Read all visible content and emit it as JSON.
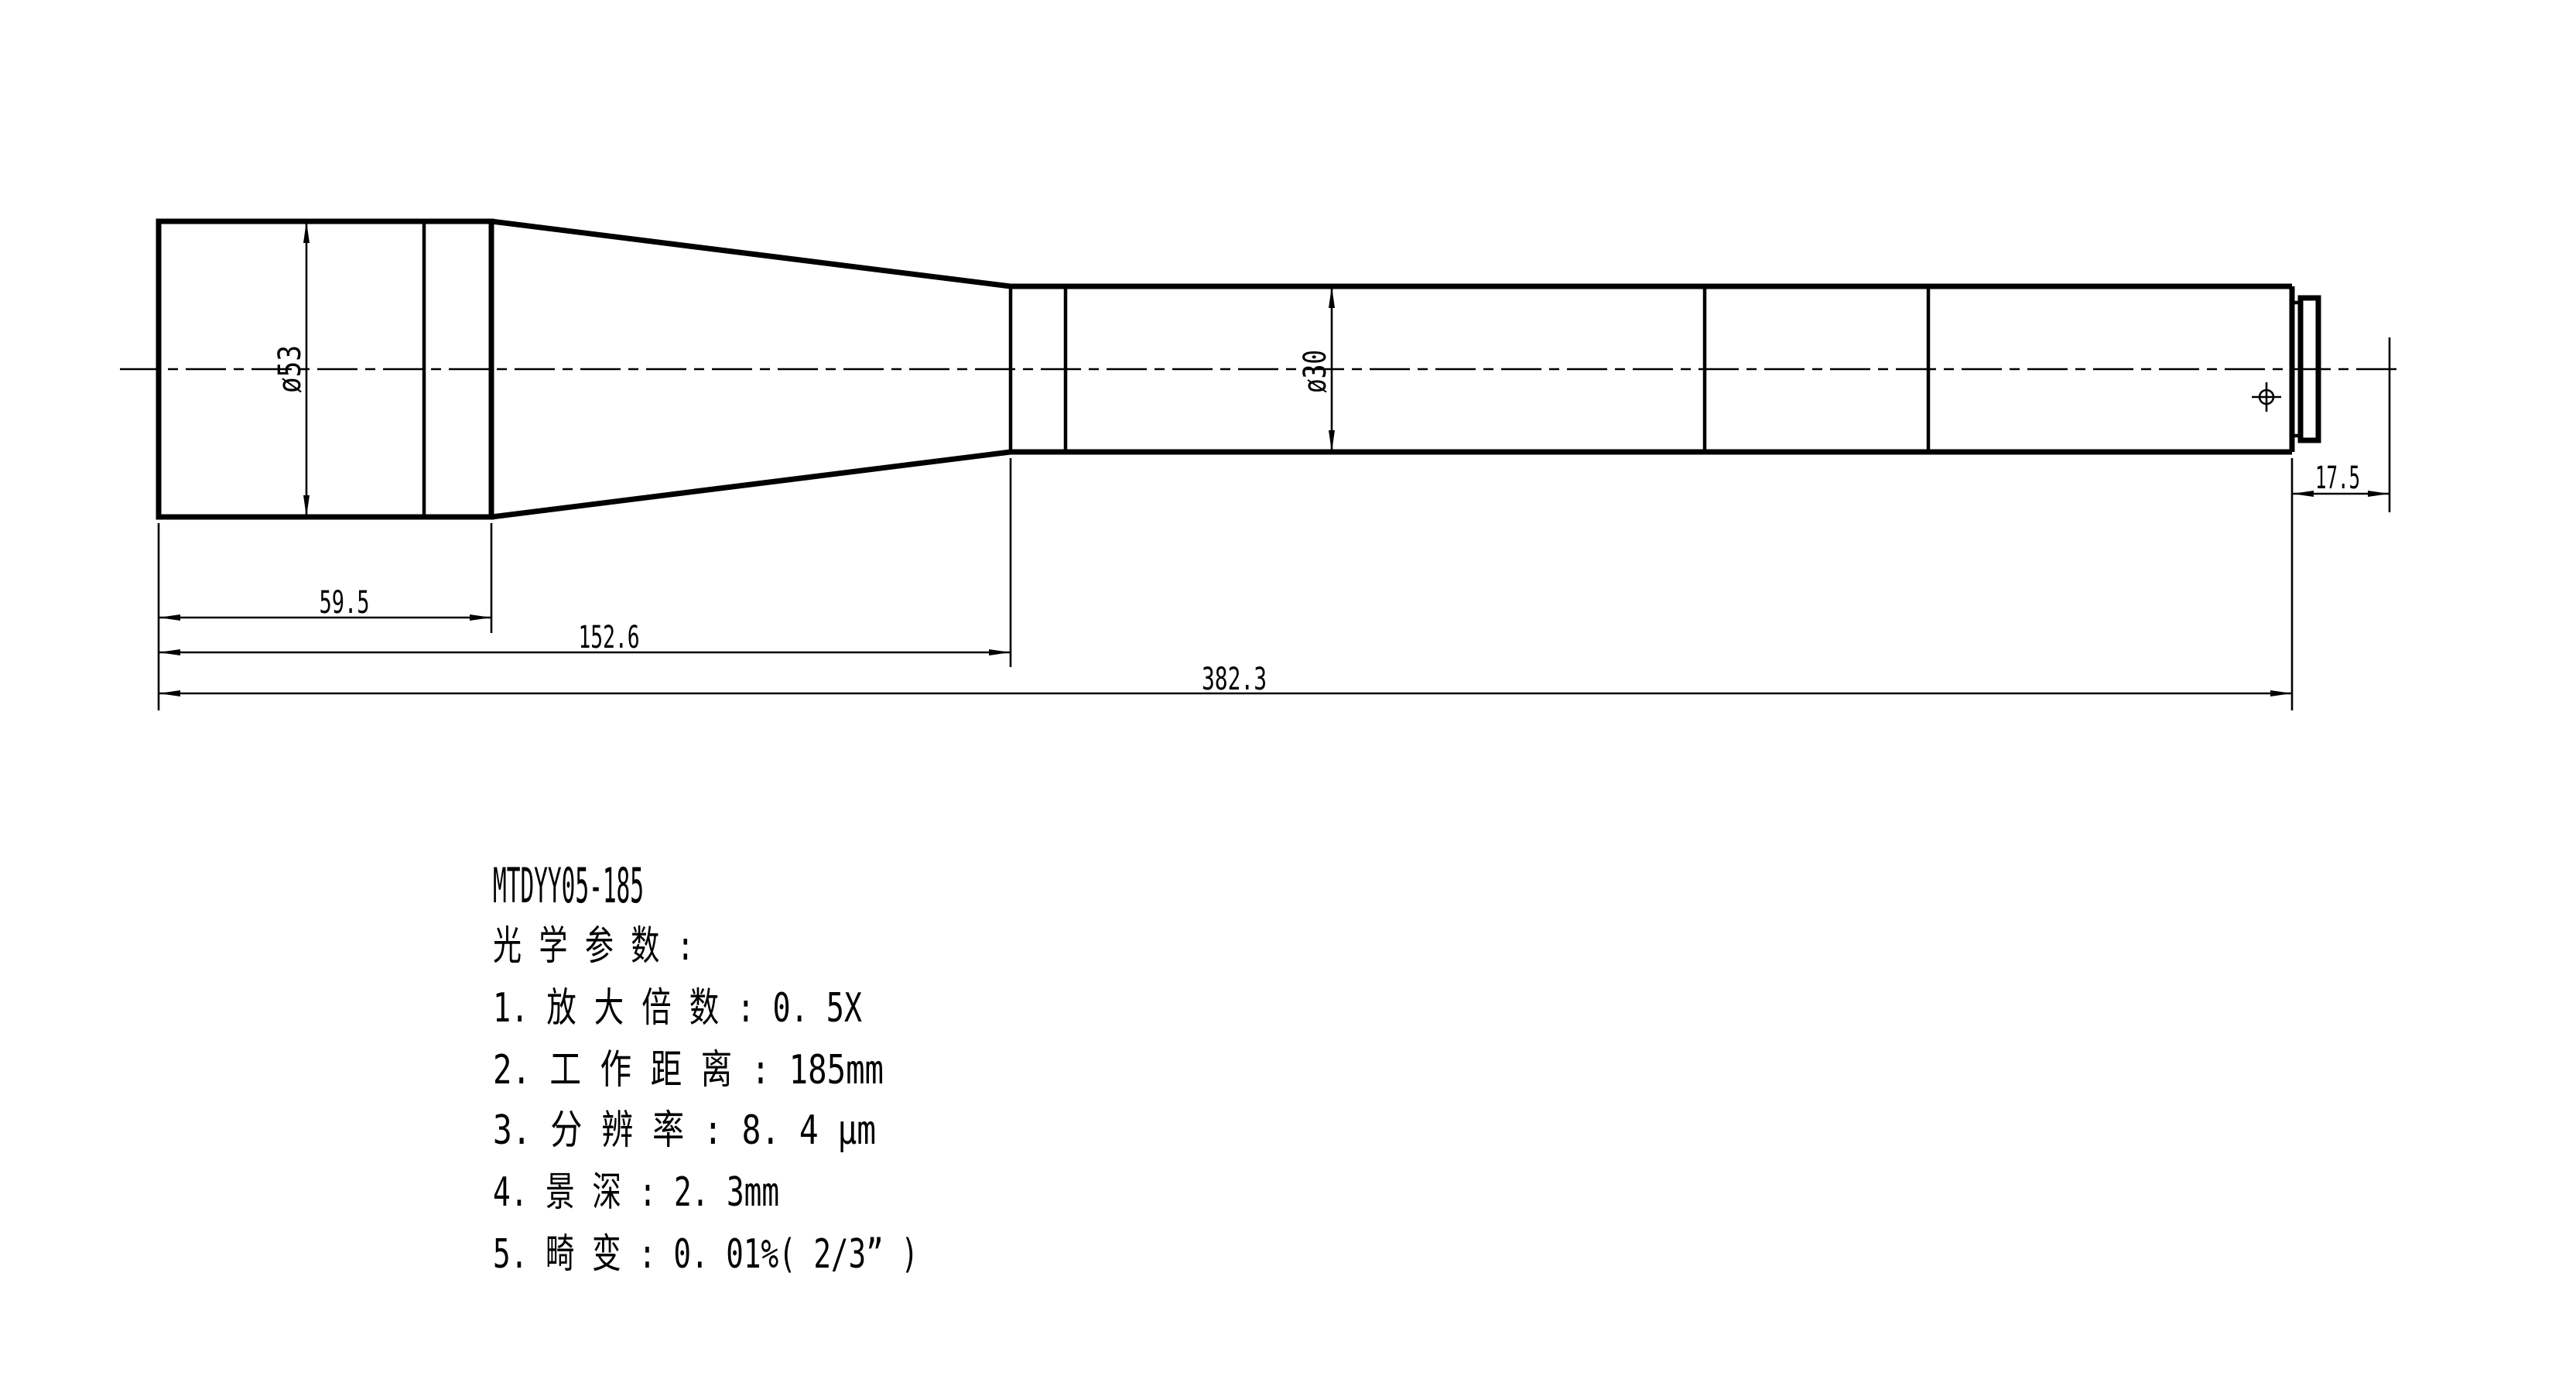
{
  "title_block": {
    "part_number": "MTDYY05-185"
  },
  "notes": {
    "header": "光 学 参 数 :",
    "items": [
      "1. 放 大 倍 数 : 0. 5X",
      "2. 工 作 距 离 : 185mm",
      "3. 分 辨 率 : 8. 4 μm",
      "4. 景 深 : 2. 3mm",
      "5. 畸 变 : 0. 01%( 2/3” )"
    ]
  },
  "dimensions": {
    "front_diameter": "ø53",
    "barrel_diameter": "ø30",
    "front_section_length": "59.5",
    "front_taper_length": "152.6",
    "overall_length": "382.3",
    "flange_to_image_plane": "17.5"
  },
  "colors": {
    "line": "#000000",
    "background": "#ffffff"
  }
}
